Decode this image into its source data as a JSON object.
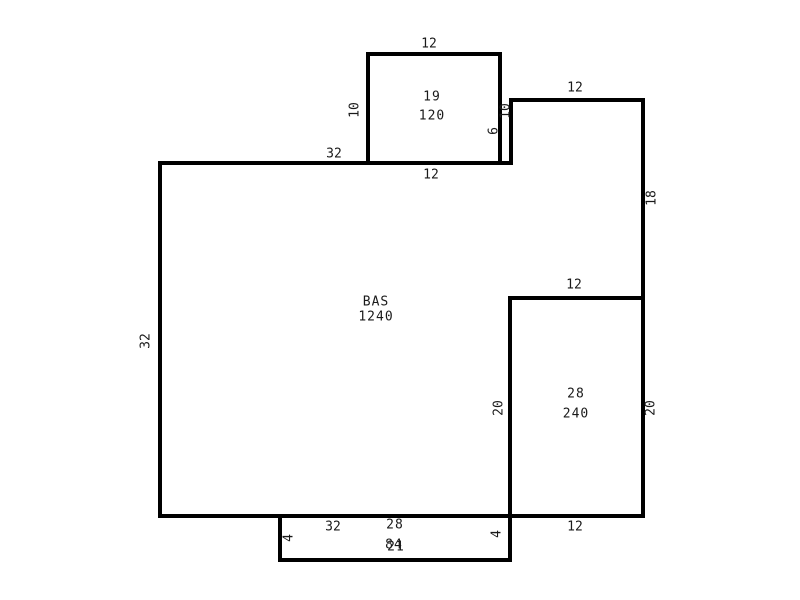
{
  "plan": {
    "type": "floor-plan-sketch",
    "canvas": {
      "width": 800,
      "height": 600,
      "background": "#ffffff"
    },
    "wall_color": "#000000",
    "text_color": "#1a1a1a",
    "rooms": [
      {
        "name": "19",
        "area": "120"
      },
      {
        "name": "BAS",
        "area": "1240"
      },
      {
        "name": "28",
        "area": "240"
      },
      {
        "name": "28",
        "area": "84",
        "note_overlapping_text": "21"
      }
    ],
    "walls": [
      {
        "n": "room19-top-wall",
        "x": 366,
        "y": 52,
        "w": 136,
        "h": 4
      },
      {
        "n": "room19-left-wall",
        "x": 366,
        "y": 52,
        "w": 4,
        "h": 113
      },
      {
        "n": "room19-right-wall",
        "x": 498,
        "y": 52,
        "w": 4,
        "h": 113
      },
      {
        "n": "bas-extension-top-wall",
        "x": 509,
        "y": 98,
        "w": 136,
        "h": 4
      },
      {
        "n": "bas-notch-wall",
        "x": 509,
        "y": 98,
        "w": 4,
        "h": 67
      },
      {
        "n": "right-outer-wall",
        "x": 641,
        "y": 98,
        "w": 4,
        "h": 420
      },
      {
        "n": "bas-top-wall",
        "x": 158,
        "y": 161,
        "w": 355,
        "h": 4
      },
      {
        "n": "bas-left-wall",
        "x": 158,
        "y": 161,
        "w": 4,
        "h": 357
      },
      {
        "n": "room28-top-wall",
        "x": 508,
        "y": 296,
        "w": 137,
        "h": 4
      },
      {
        "n": "room28-left-wall",
        "x": 508,
        "y": 296,
        "w": 4,
        "h": 266
      },
      {
        "n": "bottom-outer-wall",
        "x": 158,
        "y": 514,
        "w": 487,
        "h": 4
      },
      {
        "n": "protrusion-left-wall",
        "x": 278,
        "y": 514,
        "w": 4,
        "h": 48
      },
      {
        "n": "protrusion-bottom-wall",
        "x": 278,
        "y": 558,
        "w": 234,
        "h": 4
      }
    ],
    "labels": [
      {
        "t": "12",
        "x": 429,
        "y": 44,
        "rot": false,
        "kind": "dim",
        "n": "dim-room19-top"
      },
      {
        "t": "10",
        "x": 355,
        "y": 110,
        "rot": true,
        "kind": "dim",
        "n": "dim-room19-left"
      },
      {
        "t": "19",
        "x": 432,
        "y": 97,
        "rot": false,
        "kind": "room",
        "n": "room19-name"
      },
      {
        "t": "120",
        "x": 432,
        "y": 116,
        "rot": false,
        "kind": "room",
        "n": "room19-area"
      },
      {
        "t": "10",
        "x": 506,
        "y": 111,
        "rot": true,
        "kind": "dim",
        "n": "dim-room19-right"
      },
      {
        "t": "6",
        "x": 494,
        "y": 131,
        "rot": true,
        "kind": "dim",
        "n": "dim-bas-notch"
      },
      {
        "t": "12",
        "x": 431,
        "y": 175,
        "rot": false,
        "kind": "dim",
        "n": "dim-room19-bottom"
      },
      {
        "t": "12",
        "x": 575,
        "y": 88,
        "rot": false,
        "kind": "dim",
        "n": "dim-bas-extension-top"
      },
      {
        "t": "18",
        "x": 652,
        "y": 198,
        "rot": true,
        "kind": "dim",
        "n": "dim-right-wall-upper"
      },
      {
        "t": "32",
        "x": 334,
        "y": 154,
        "rot": false,
        "kind": "dim",
        "n": "dim-bas-top"
      },
      {
        "t": "32",
        "x": 146,
        "y": 341,
        "rot": true,
        "kind": "dim",
        "n": "dim-bas-left"
      },
      {
        "t": "BAS",
        "x": 376,
        "y": 302,
        "rot": false,
        "kind": "room",
        "n": "bas-name"
      },
      {
        "t": "1240",
        "x": 376,
        "y": 317,
        "rot": false,
        "kind": "room",
        "n": "bas-area"
      },
      {
        "t": "12",
        "x": 574,
        "y": 285,
        "rot": false,
        "kind": "dim",
        "n": "dim-room28-top"
      },
      {
        "t": "28",
        "x": 576,
        "y": 394,
        "rot": false,
        "kind": "room",
        "n": "room28-name"
      },
      {
        "t": "240",
        "x": 576,
        "y": 414,
        "rot": false,
        "kind": "room",
        "n": "room28-area"
      },
      {
        "t": "20",
        "x": 499,
        "y": 408,
        "rot": true,
        "kind": "dim",
        "n": "dim-room28-left"
      },
      {
        "t": "20",
        "x": 651,
        "y": 408,
        "rot": true,
        "kind": "dim",
        "n": "dim-room28-right"
      },
      {
        "t": "12",
        "x": 575,
        "y": 527,
        "rot": false,
        "kind": "dim",
        "n": "dim-room28-bottom"
      },
      {
        "t": "32",
        "x": 333,
        "y": 527,
        "rot": false,
        "kind": "dim",
        "n": "dim-bas-bottom"
      },
      {
        "t": "4",
        "x": 289,
        "y": 538,
        "rot": true,
        "kind": "dim",
        "n": "dim-protrusion-left"
      },
      {
        "t": "4",
        "x": 497,
        "y": 534,
        "rot": true,
        "kind": "dim",
        "n": "dim-protrusion-right"
      },
      {
        "t": "28",
        "x": 395,
        "y": 525,
        "rot": false,
        "kind": "room",
        "n": "protrusion-label-line1"
      },
      {
        "t": "84",
        "x": 394,
        "y": 545,
        "rot": false,
        "kind": "room",
        "n": "protrusion-label-line2a"
      },
      {
        "t": "21",
        "x": 396,
        "y": 547,
        "rot": false,
        "kind": "room",
        "n": "protrusion-label-line2b"
      }
    ]
  }
}
